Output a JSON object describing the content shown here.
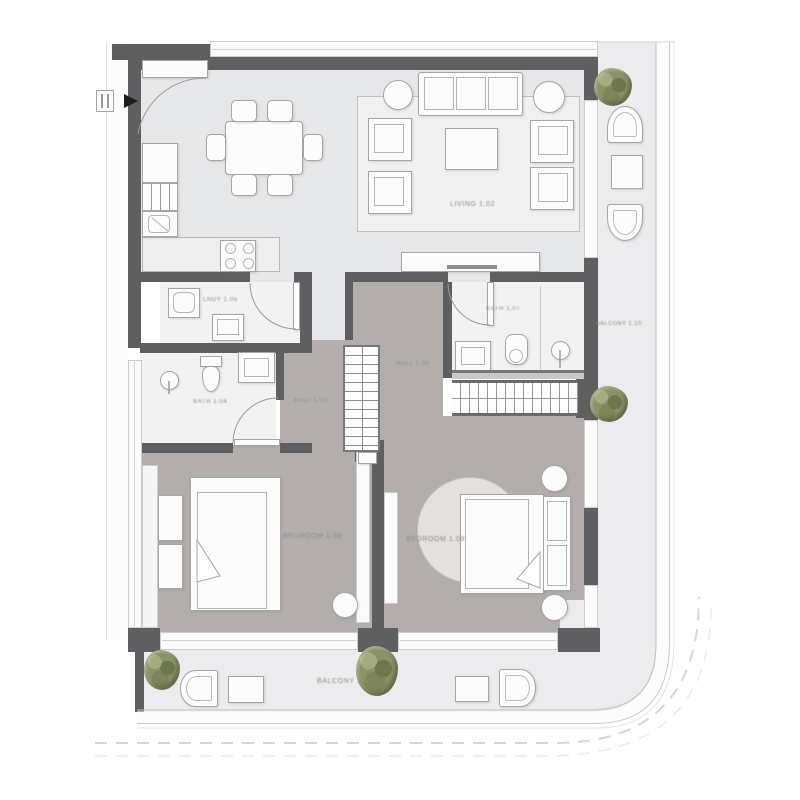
{
  "title": "Two-bedroom apartment floor plan",
  "colors": {
    "wall": "#5f5f61",
    "floor_living": "#e6e7e8",
    "floor_bedroom_hall": "#b3aeab",
    "floor_bath": "#f2f2f3",
    "floor_balcony": "#ececee",
    "furniture_fill": "#fcfcfc",
    "furniture_line": "#a6a6a6",
    "plant_green": "#8a9366",
    "label_gray": "#8c8c8c"
  },
  "rooms": {
    "living": {
      "label": "LIVING 1.02"
    },
    "laundry": {
      "label": "LNDY 1.05"
    },
    "bath_main": {
      "label": "BATH 1.07"
    },
    "bath_ensuite": {
      "label": "BATH 1.04"
    },
    "hall": {
      "label": "HALL 1.06"
    },
    "corridor": {
      "label": "HALL 1.03"
    },
    "bedroom_1": {
      "label": "BEDROOM 1.08"
    },
    "bedroom_2": {
      "label": "BEDROOM 1.09"
    },
    "balcony_side": {
      "label": "BALCONY 1.10"
    },
    "balcony_front": {
      "label": "BALCONY 1.11"
    }
  },
  "furniture": [
    "dining-table",
    "dining-chairs",
    "kitchen-counter",
    "cooktop",
    "refrigerator",
    "kitchen-sink",
    "sofa",
    "armchairs",
    "coffee-table",
    "side-tables",
    "area-rug",
    "tv-console",
    "washer",
    "laundry-sink",
    "toilets",
    "bathroom-sinks",
    "showers",
    "wardrobe",
    "shelving",
    "double-beds",
    "nightstands",
    "round-rug",
    "stool",
    "lounge-chairs",
    "patio-tables",
    "plants"
  ]
}
